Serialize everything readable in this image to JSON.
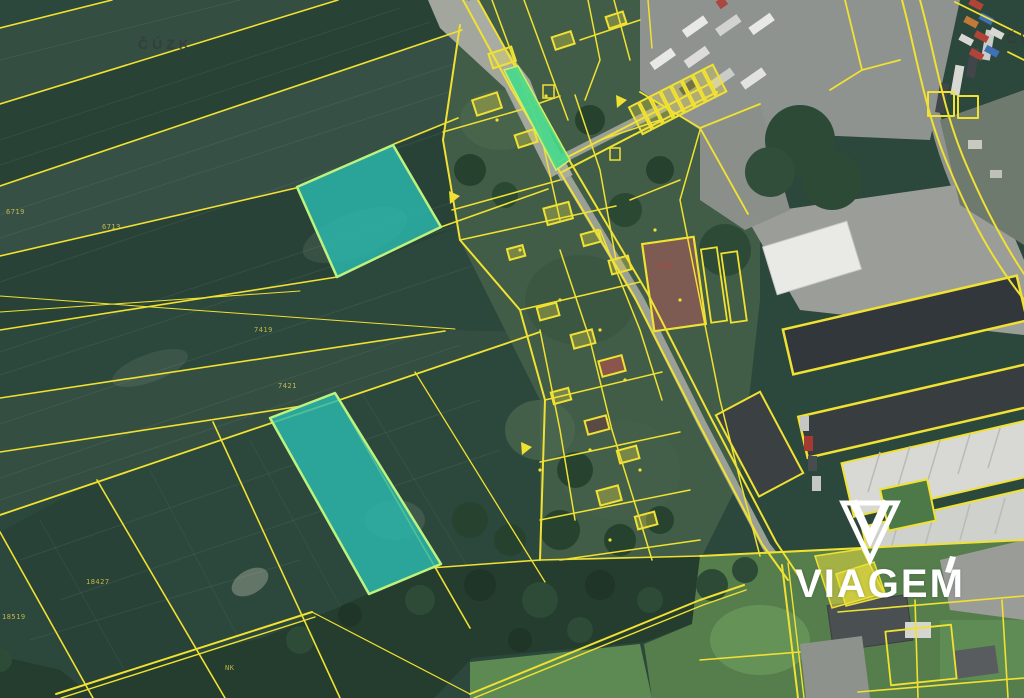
{
  "map": {
    "provider_watermark": "ČÚZK",
    "provider_watermark_right": "ČÚZK",
    "brand": {
      "name": "VIAGEM",
      "mark": "gem-icon"
    },
    "colors": {
      "parcel_line_yellow": "#f0e132",
      "highlight_teal_fill": "#2bb9af",
      "highlight_teal_border": "#bdf27f",
      "highlight_green_fill": "#45d98c",
      "highlight_yellow_fill": "#f2e43b",
      "field_green": "#2c473b",
      "forest_green": "#243d2e",
      "meadow_green": "#5b8a51",
      "asphalt_gray": "#8f938f",
      "watermark_gray": "#333d38",
      "logo_white": "#ffffff"
    },
    "highlighted_parcels": [
      {
        "id": "teal-north",
        "points": "297,187 393,145 441,227 337,277"
      },
      {
        "id": "teal-south",
        "points": "270,418 335,393 441,564 369,594"
      },
      {
        "id": "green-road-strip",
        "points": "504,70 518,66 570,160 556,170"
      },
      {
        "id": "yellow-a",
        "points": "815,556 862,549 884,593 832,608"
      },
      {
        "id": "yellow-b",
        "points": "836,574 874,562 886,596 846,606"
      }
    ],
    "parcel_labels": [
      "6719",
      "6713",
      "7419",
      "7421",
      "18427",
      "18519",
      "NK",
      "614"
    ]
  }
}
